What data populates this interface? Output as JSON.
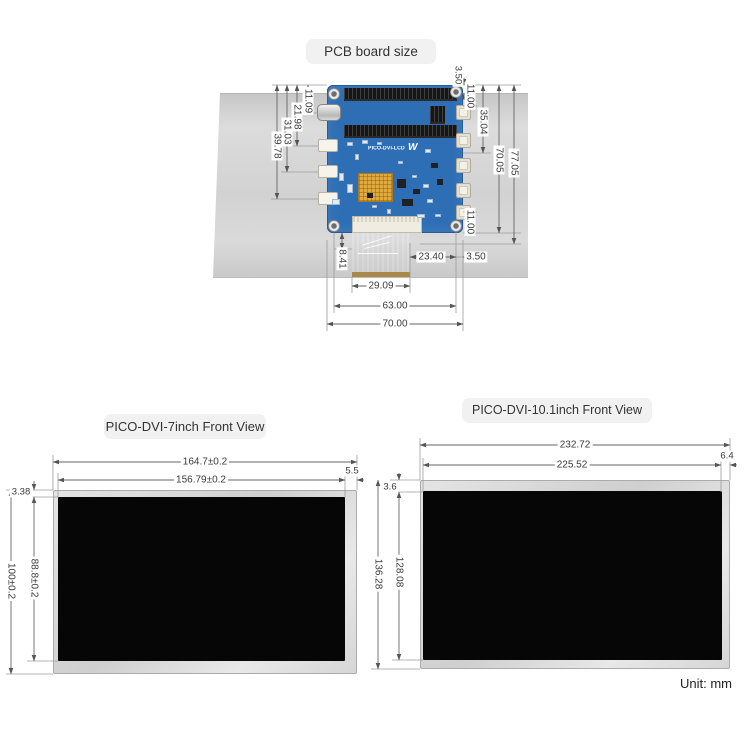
{
  "pcb": {
    "title": "PCB board size",
    "silkscreen": "PICO-DVI-LCD",
    "logo": "W",
    "dim_left": [
      "11.09",
      "21.98",
      "31.03",
      "39.78"
    ],
    "dim_right": [
      "3.50",
      "11.00",
      "35.04",
      "70.05",
      "77.05",
      "11.00"
    ],
    "dim_bottom": [
      "8.41",
      "23.40",
      "3.50",
      "29.09",
      "63.00",
      "70.00"
    ]
  },
  "view7": {
    "title": "PICO-DVI-7inch Front View",
    "outer_width": "164.7±0.2",
    "inner_width": "156.79±0.2",
    "side_gap": "5.5",
    "top_gap": "3.38",
    "outer_height": "100±0.2",
    "inner_height": "88.8±0.2"
  },
  "view10": {
    "title": "PICO-DVI-10.1inch Front View",
    "outer_width": "232.72",
    "inner_width": "225.52",
    "side_gap": "6.4",
    "top_gap": "3.6",
    "outer_height": "136.28",
    "inner_height": "128.08"
  },
  "footer": {
    "unit": "Unit: mm"
  },
  "colors": {
    "pcb_blue": "#2e6eb5",
    "cable_orange": "#d8862a",
    "panel_gray": "#d3d3d3",
    "dim_line": "#8c8c8c"
  }
}
